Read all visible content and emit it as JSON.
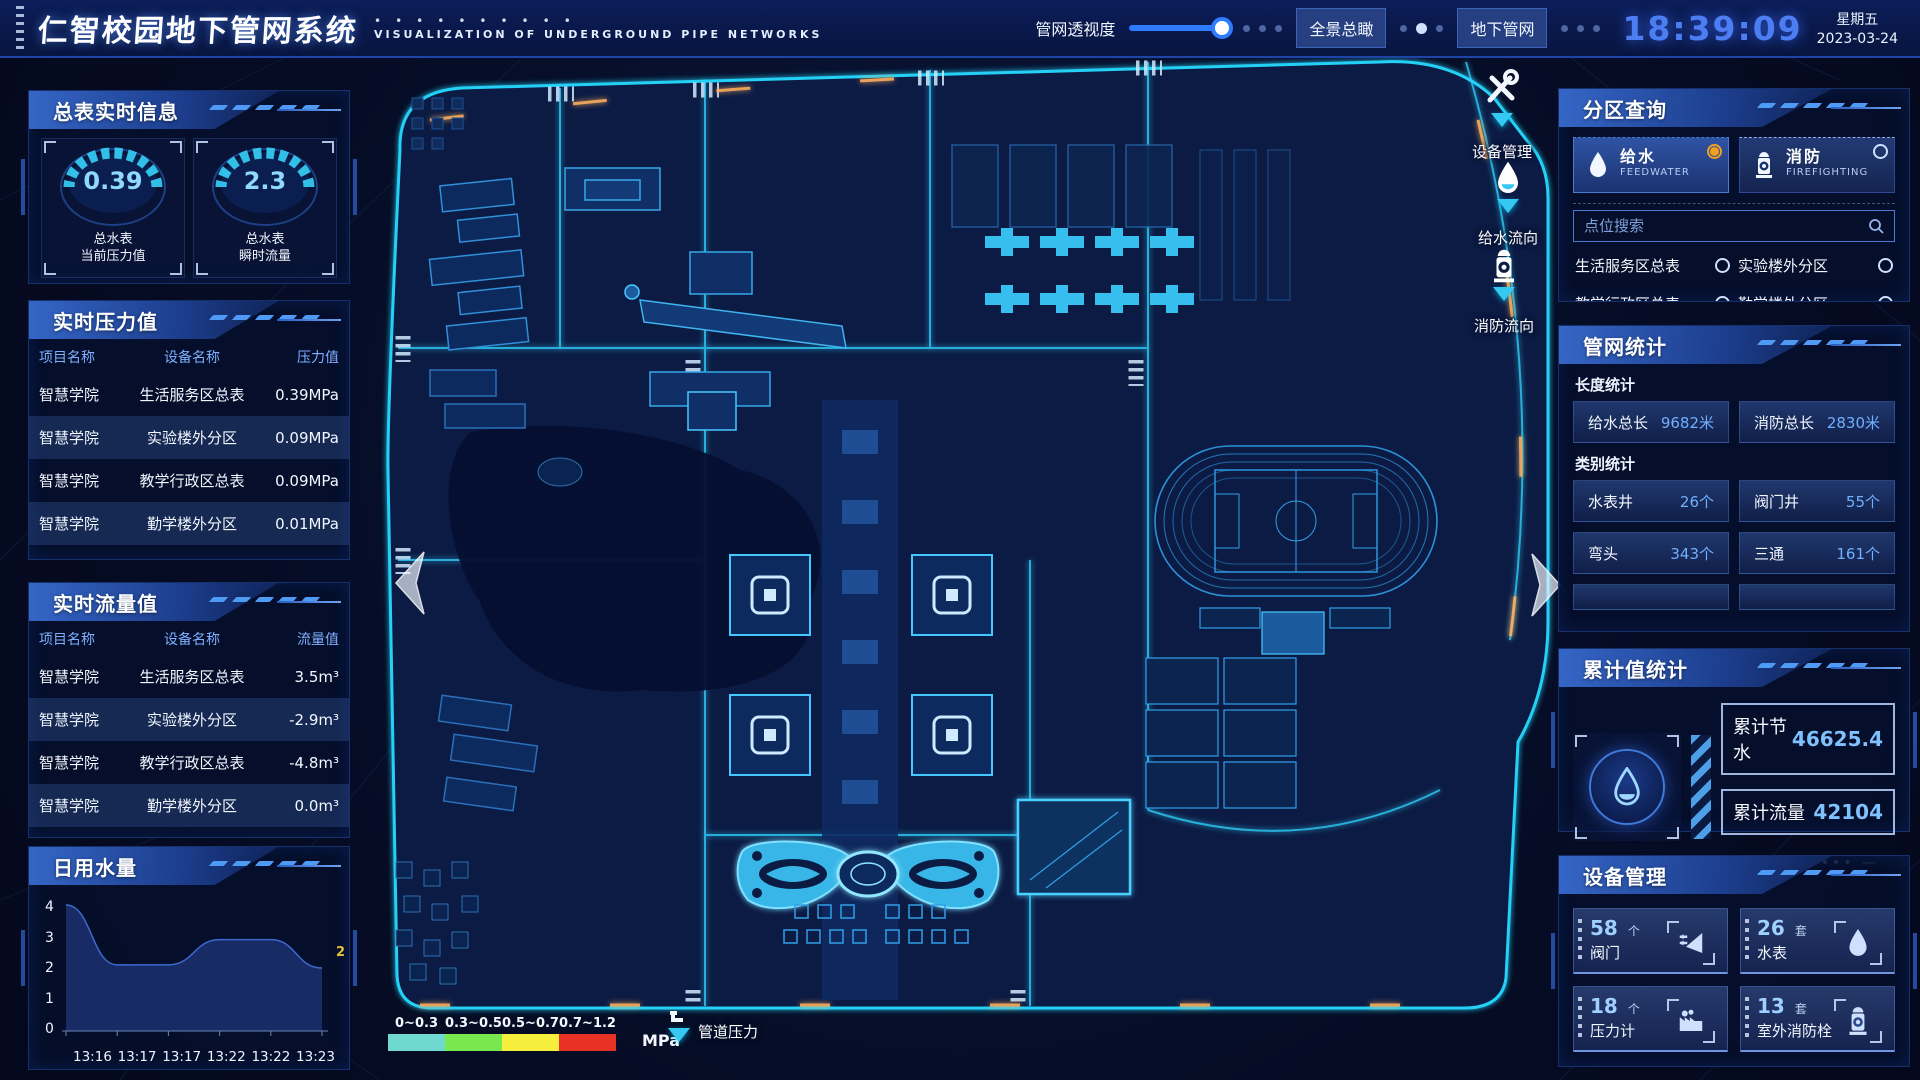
{
  "header": {
    "title": "仁智校园地下管网系统",
    "subtitle": "VISUALIZATION OF UNDERGROUND PIPE NETWORKS",
    "slider_label": "管网透视度",
    "btn_overview": "全景总瞰",
    "btn_underground": "地下管网",
    "time": "18:39:09",
    "weekday": "星期五",
    "date": "2023-03-24"
  },
  "left": {
    "meter": {
      "title": "总表实时信息",
      "gauges": [
        {
          "value": "0.39",
          "line1": "总水表",
          "line2": "当前压力值"
        },
        {
          "value": "2.3",
          "line1": "总水表",
          "line2": "瞬时流量"
        }
      ]
    },
    "pressure": {
      "title": "实时压力值",
      "headers": [
        "项目名称",
        "设备名称",
        "压力值"
      ],
      "rows": [
        [
          "智慧学院",
          "生活服务区总表",
          "0.39MPa"
        ],
        [
          "智慧学院",
          "实验楼外分区",
          "0.09MPa"
        ],
        [
          "智慧学院",
          "教学行政区总表",
          "0.09MPa"
        ],
        [
          "智慧学院",
          "勤学楼外分区",
          "0.01MPa"
        ],
        [
          "智慧学院",
          "砺学楼外分区",
          "0.09MPa"
        ]
      ]
    },
    "flow": {
      "title": "实时流量值",
      "headers": [
        "项目名称",
        "设备名称",
        "流量值"
      ],
      "rows": [
        [
          "智慧学院",
          "生活服务区总表",
          "3.5m³"
        ],
        [
          "智慧学院",
          "实验楼外分区",
          "-2.9m³"
        ],
        [
          "智慧学院",
          "教学行政区总表",
          "-4.8m³"
        ],
        [
          "智慧学院",
          "勤学楼外分区",
          "0.0m³"
        ],
        [
          "智慧学院",
          "砺学楼外分区",
          "2.3m³"
        ]
      ]
    },
    "daily": {
      "title": "日用水量"
    }
  },
  "right": {
    "query": {
      "title": "分区查询",
      "feed": {
        "label": "给水",
        "sub": "FEEDWATER"
      },
      "fire": {
        "label": "消防",
        "sub": "FIREFIGHTING"
      },
      "search_placeholder": "点位搜索",
      "options": [
        "生活服务区总表",
        "实验楼外分区",
        "教学行政区总表",
        "勤学楼外分区",
        "砺学楼外分区",
        "宿舍区泵房"
      ]
    },
    "stats": {
      "title": "管网统计",
      "length_title": "长度统计",
      "length": [
        {
          "label": "给水总长",
          "value": "9682米"
        },
        {
          "label": "消防总长",
          "value": "2830米"
        }
      ],
      "category_title": "类别统计",
      "category": [
        {
          "label": "水表井",
          "value": "26个"
        },
        {
          "label": "阀门井",
          "value": "55个"
        },
        {
          "label": "弯头",
          "value": "343个"
        },
        {
          "label": "三通",
          "value": "161个"
        }
      ]
    },
    "total": {
      "title": "累计值统计",
      "rows": [
        {
          "label": "累计节水",
          "value": "46625.4"
        },
        {
          "label": "累计流量",
          "value": "42104"
        }
      ]
    },
    "device": {
      "title": "设备管理",
      "items": [
        {
          "count": "58",
          "unit": "个",
          "label": "阀门"
        },
        {
          "count": "26",
          "unit": "套",
          "label": "水表"
        },
        {
          "count": "18",
          "unit": "个",
          "label": "压力计"
        },
        {
          "count": "13",
          "unit": "套",
          "label": "室外消防栓"
        }
      ]
    }
  },
  "map": {
    "markers": {
      "device": "设备管理",
      "feed": "给水流向",
      "fire": "消防流向"
    },
    "legend": {
      "ranges": [
        "0~0.3",
        "0.3~0.5",
        "0.5~0.7",
        "0.7~1.2"
      ],
      "colors": [
        "#6fd8cf",
        "#78e84e",
        "#f5ee3d",
        "#e83224"
      ],
      "unit": "MPa",
      "pressure_label": "管道压力"
    }
  },
  "chart_data": {
    "type": "area",
    "title": "日用水量",
    "x": [
      "13:16",
      "13:17",
      "13:17",
      "13:22",
      "13:22",
      "13:23"
    ],
    "values": [
      4,
      2.1,
      2.1,
      2.9,
      2.9,
      2
    ],
    "yticks_display": [
      "4",
      "3",
      "2",
      "1",
      "0"
    ],
    "ylim": [
      0,
      4
    ],
    "end_label": "2",
    "grid": false,
    "legend_position": "none"
  }
}
